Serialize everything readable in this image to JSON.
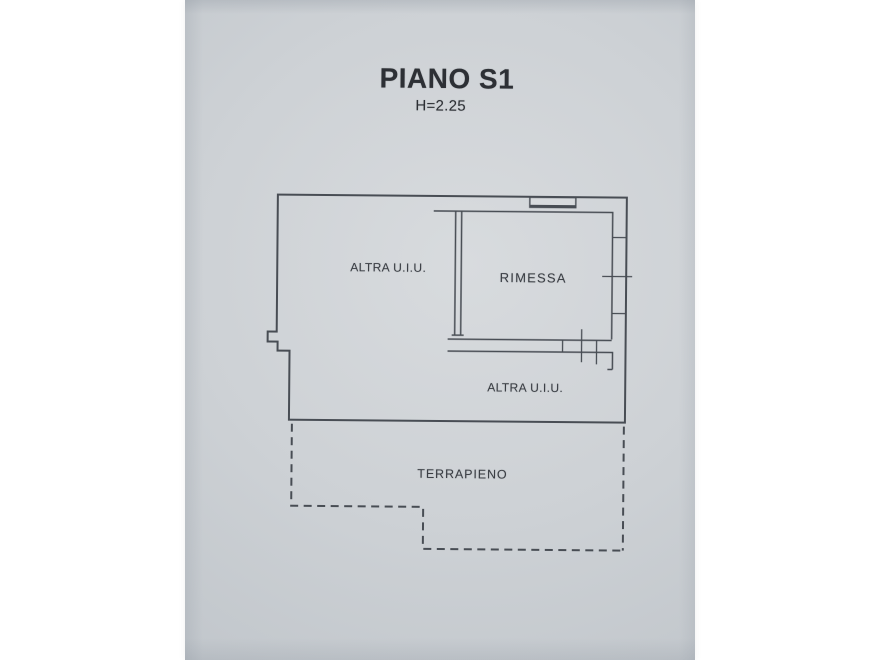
{
  "header": {
    "title": "PIANO S1",
    "height_note": "H=2.25"
  },
  "rooms": [
    {
      "id": "altra-uiu-upper",
      "label": "ALTRA U.I.U."
    },
    {
      "id": "rimessa",
      "label": "RIMESSA"
    },
    {
      "id": "altra-uiu-lower",
      "label": "ALTRA U.I.U."
    },
    {
      "id": "terrapieno",
      "label": "TERRAPIENO"
    }
  ],
  "drawing": {
    "kind": "floor-plan",
    "wall_line_style": "solid",
    "terrapieno_line_style": "dashed"
  },
  "colors": {
    "page_background": "#ffffff",
    "paper": "#cdd1d5",
    "paper_light": "#d8dbde",
    "paper_dark": "#aeb5bd",
    "line": "#484d54",
    "text": "#3a3e44",
    "title": "#2d3035"
  }
}
